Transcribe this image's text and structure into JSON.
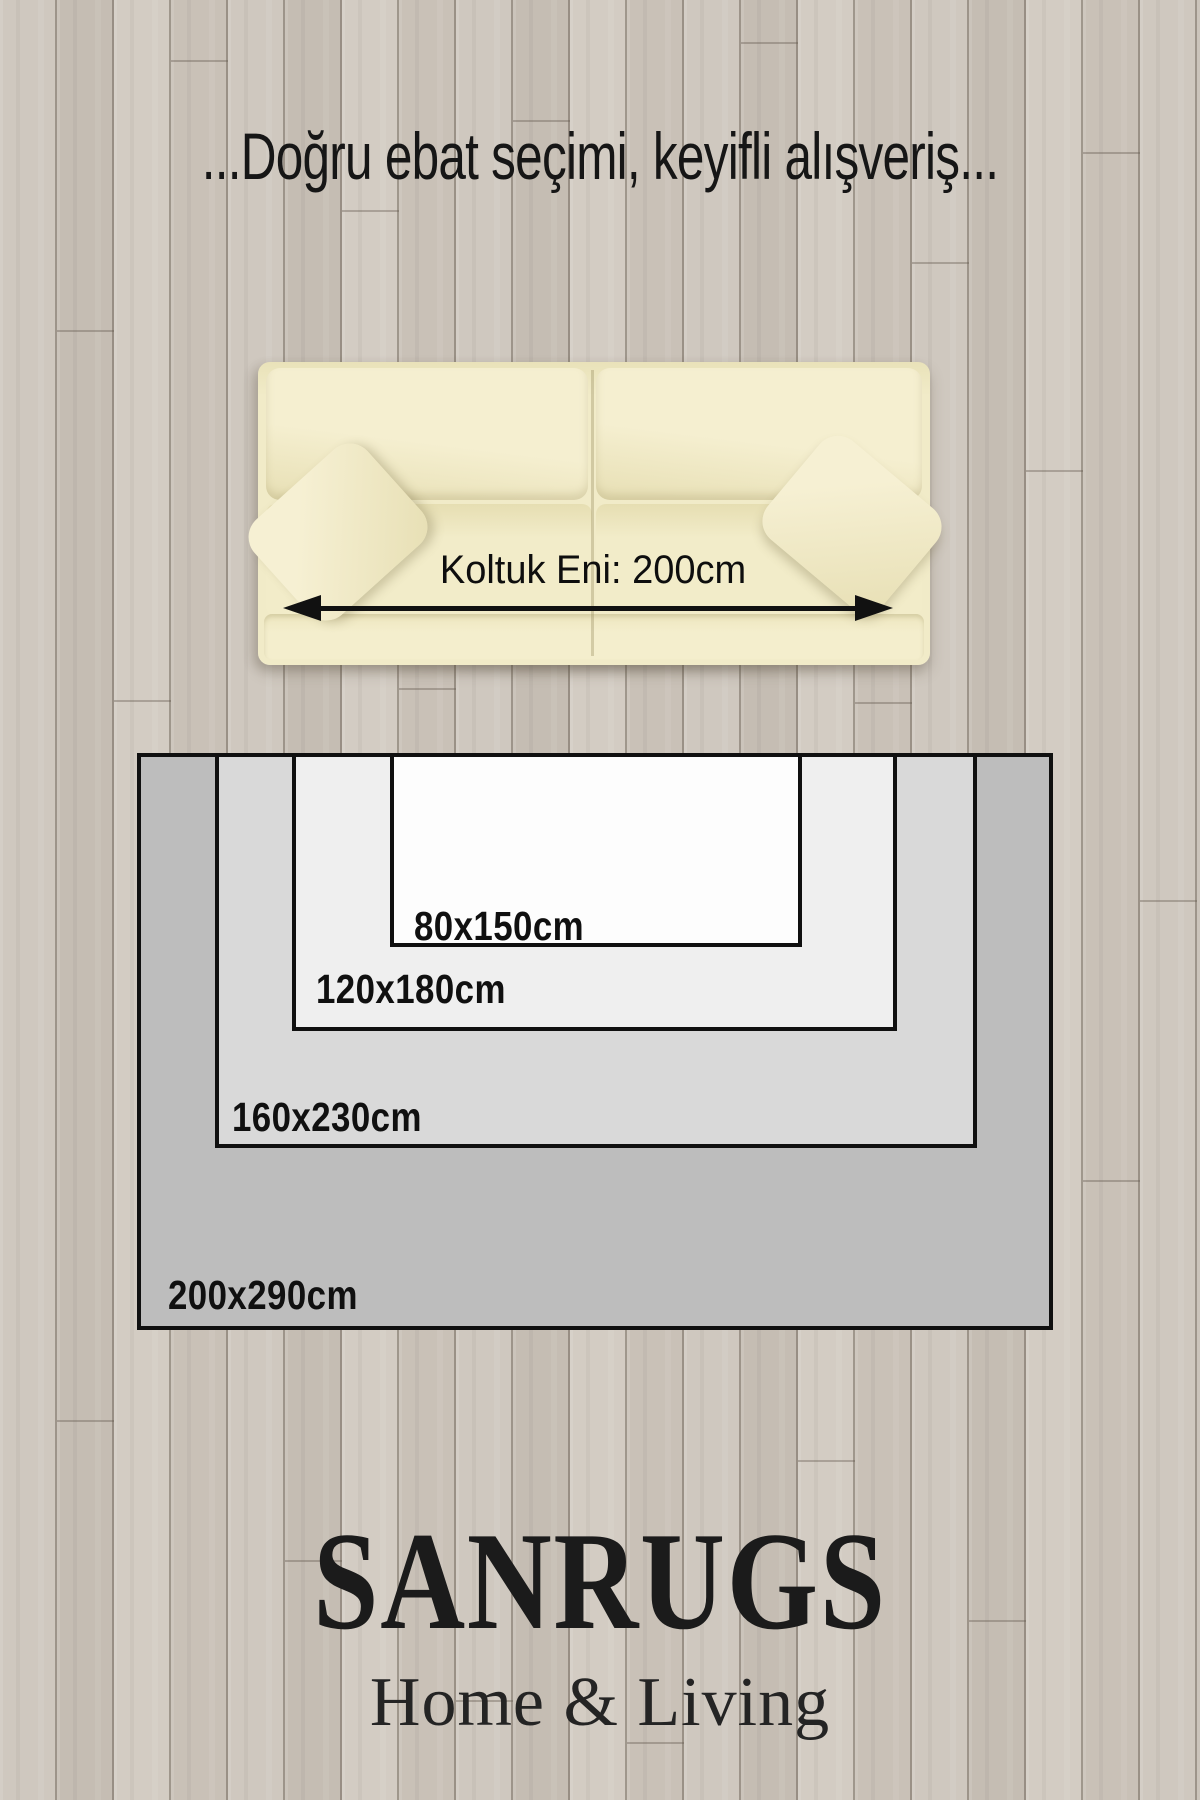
{
  "title": "...Doğru ebat seçimi, keyifli alışveriş...",
  "sofa": {
    "width_label": "Koltuk Eni: 200cm"
  },
  "rugs": [
    {
      "size": "80x150cm",
      "label": "80x150cm",
      "fill": "#fdfdfd"
    },
    {
      "size": "120x180cm",
      "label": "120x180cm",
      "fill": "#efefef"
    },
    {
      "size": "160x230cm",
      "label": "160x230cm",
      "fill": "#d9d9d9"
    },
    {
      "size": "200x290cm",
      "label": "200x290cm",
      "fill": "#bdbdbd"
    }
  ],
  "brand": {
    "name": "SANRUGS",
    "tagline": "Home & Living"
  },
  "colors": {
    "floor": "#ccc5bc",
    "sofa_cream": "#f1ebc8",
    "outline": "#101010",
    "text": "#161616"
  }
}
